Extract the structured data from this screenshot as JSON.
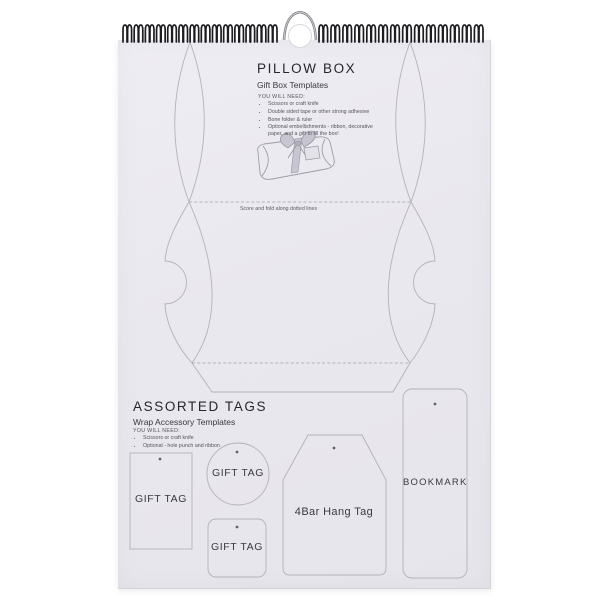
{
  "pillow_box": {
    "title": "PILLOW BOX",
    "subtitle": "Gift Box Templates",
    "needs_heading": "YOU WILL NEED:",
    "needs": [
      "Scissors or craft knife",
      "Double sided tape or other strong adhesive",
      "Bone folder & ruler",
      "Optional embellishments - ribbon, decorative paper, and a gift to fill the box!"
    ],
    "fold_note": "Score and fold along dotted lines"
  },
  "assorted_tags": {
    "title": "ASSORTED TAGS",
    "subtitle": "Wrap Accessory Templates",
    "needs_heading": "YOU WILL NEED:",
    "needs": [
      "Scissors or craft knife",
      "Optional - hole punch and ribbon"
    ],
    "templates": {
      "gift_tag_rect": "GIFT TAG",
      "gift_tag_circle": "GIFT TAG",
      "gift_tag_square": "GIFT TAG",
      "hang_tag": "4Bar Hang Tag",
      "bookmark": "BOOKMARK"
    }
  },
  "binding": {
    "left_loops": 14,
    "right_loops": 14
  },
  "colors": {
    "paper": "#e9e8ee",
    "outline": "#b3b1bb",
    "ink": "#2a2a30",
    "wire": "#1d1d21",
    "ribbon": "#c6c5d0",
    "hole_dot": "#63636b"
  }
}
